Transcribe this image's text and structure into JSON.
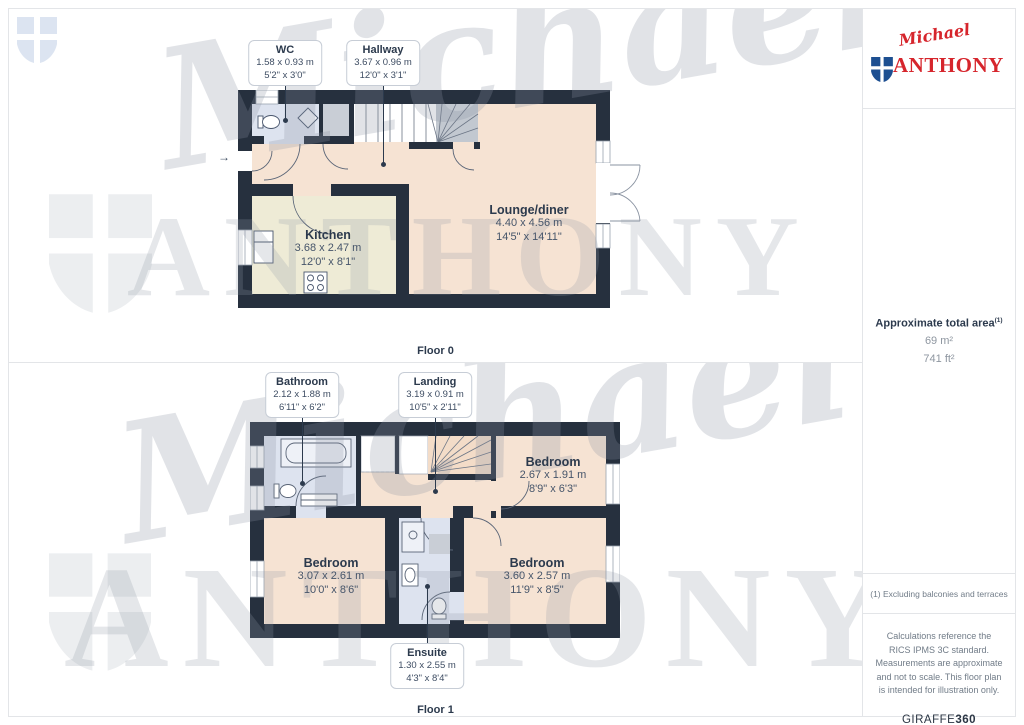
{
  "brand": {
    "script": "Michael",
    "serif": "ANTHONY"
  },
  "watermark": {
    "script": "Michael",
    "serif": "ANTHONY"
  },
  "sidebar": {
    "total_area_label": "Approximate total area",
    "total_area_sup": "(1)",
    "area_m2": "69 m²",
    "area_ft2": "741 ft²",
    "footnote1": "(1) Excluding balconies and terraces",
    "disclaimer": "Calculations reference the RICS IPMS 3C standard. Measurements are approximate and not to scale. This floor plan is intended for illustration only.",
    "credit_normal": "GIRAFFE",
    "credit_bold": "360"
  },
  "floor0": {
    "caption": "Floor 0",
    "entry_arrow": "→",
    "callouts": [
      {
        "name": "WC",
        "metric": "1.58 x 0.93 m",
        "imperial": "5'2\" x 3'0\""
      },
      {
        "name": "Hallway",
        "metric": "3.67 x 0.96 m",
        "imperial": "12'0\" x 3'1\""
      }
    ],
    "rooms": [
      {
        "name": "Kitchen",
        "metric": "3.68 x 2.47 m",
        "imperial": "12'0\" x 8'1\""
      },
      {
        "name": "Lounge/diner",
        "metric": "4.40 x 4.56 m",
        "imperial": "14'5\" x 14'11\""
      }
    ]
  },
  "floor1": {
    "caption": "Floor 1",
    "callouts": [
      {
        "name": "Bathroom",
        "metric": "2.12 x 1.88 m",
        "imperial": "6'11\" x 6'2\""
      },
      {
        "name": "Landing",
        "metric": "3.19 x 0.91 m",
        "imperial": "10'5\" x 2'11\""
      },
      {
        "name": "Ensuite",
        "metric": "1.30 x 2.55 m",
        "imperial": "4'3\" x 8'4\""
      }
    ],
    "rooms": [
      {
        "name": "Bedroom",
        "metric": "2.67 x 1.91 m",
        "imperial": "8'9\" x 6'3\""
      },
      {
        "name": "Bedroom",
        "metric": "3.07 x 2.61 m",
        "imperial": "10'0\" x 8'6\""
      },
      {
        "name": "Bedroom",
        "metric": "3.60 x 2.57 m",
        "imperial": "11'9\" x 8'5\""
      }
    ]
  }
}
